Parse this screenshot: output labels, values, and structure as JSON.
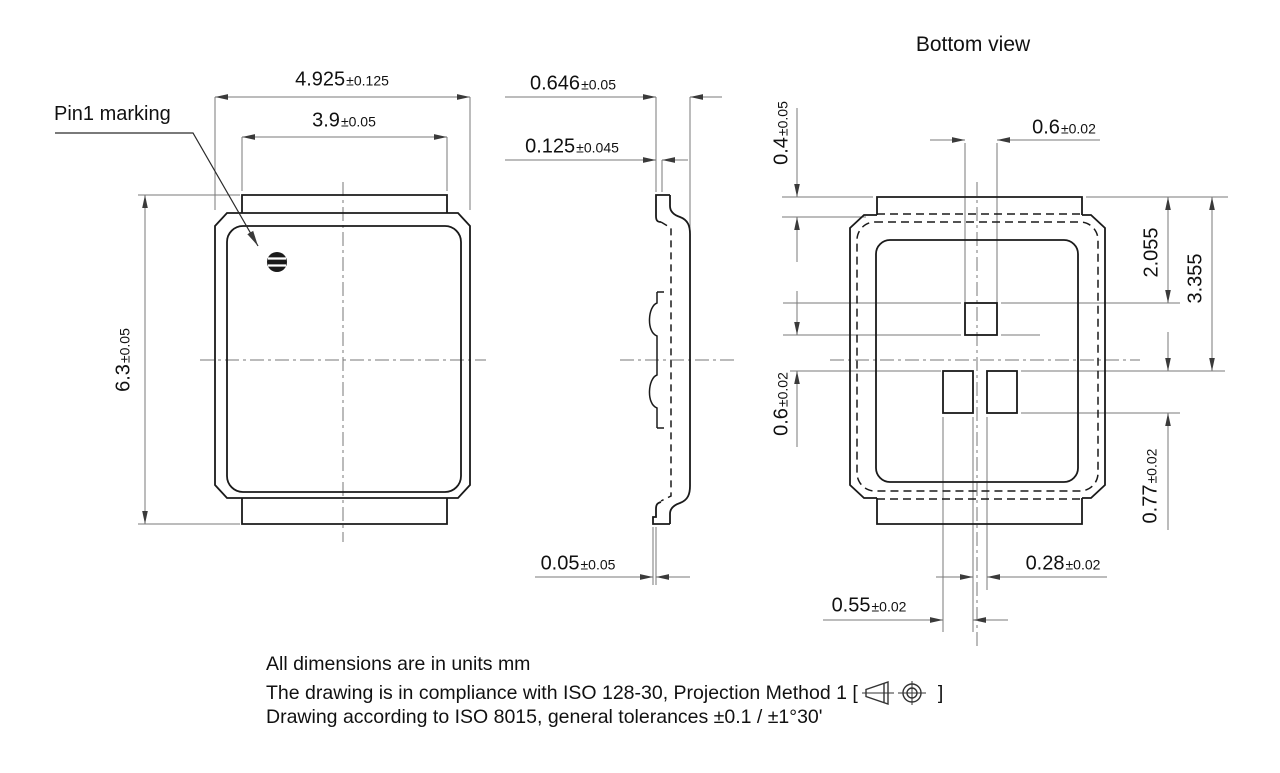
{
  "title": "Bottom view",
  "labels": {
    "pin1": "Pin1 marking"
  },
  "colors": {
    "body_line": "#1a1a1a",
    "dim_line": "#7a7a7a",
    "arrow": "#3a3a3a",
    "background": "#ffffff"
  },
  "dimensions": {
    "top_view": {
      "overall_width": {
        "value": "4.925",
        "tol": "±0.125"
      },
      "tab_width": {
        "value": "3.9",
        "tol": "±0.05"
      },
      "overall_height": {
        "value": "6.3",
        "tol": "±0.05"
      }
    },
    "side_view": {
      "total_thickness": {
        "value": "0.646",
        "tol": "±0.05"
      },
      "lid_offset": {
        "value": "0.125",
        "tol": "±0.045"
      },
      "standoff": {
        "value": "0.05",
        "tol": "±0.05"
      }
    },
    "bottom_view": {
      "tab_height": {
        "value": "0.4",
        "tol": "±0.05"
      },
      "center_pad_width": {
        "value": "0.6",
        "tol": "±0.02"
      },
      "center_pad_offset": {
        "value": "2.055",
        "tol": ""
      },
      "corner_pads_offset": {
        "value": "3.355",
        "tol": ""
      },
      "pad_gap_vertical": {
        "value": "0.6",
        "tol": "±0.02"
      },
      "pad_height": {
        "value": "0.77",
        "tol": "±0.02"
      },
      "pad_gap_horizontal": {
        "value": "0.28",
        "tol": "±0.02"
      },
      "pad_width": {
        "value": "0.55",
        "tol": "±0.02"
      }
    }
  },
  "notes": {
    "line1": "All dimensions are in units mm",
    "line2_prefix": "The drawing is in compliance with ISO 128-30, Projection Method 1 [",
    "line2_suffix": "]",
    "line3": "Drawing according to ISO 8015, general tolerances ±0.1 / ±1°30'"
  }
}
